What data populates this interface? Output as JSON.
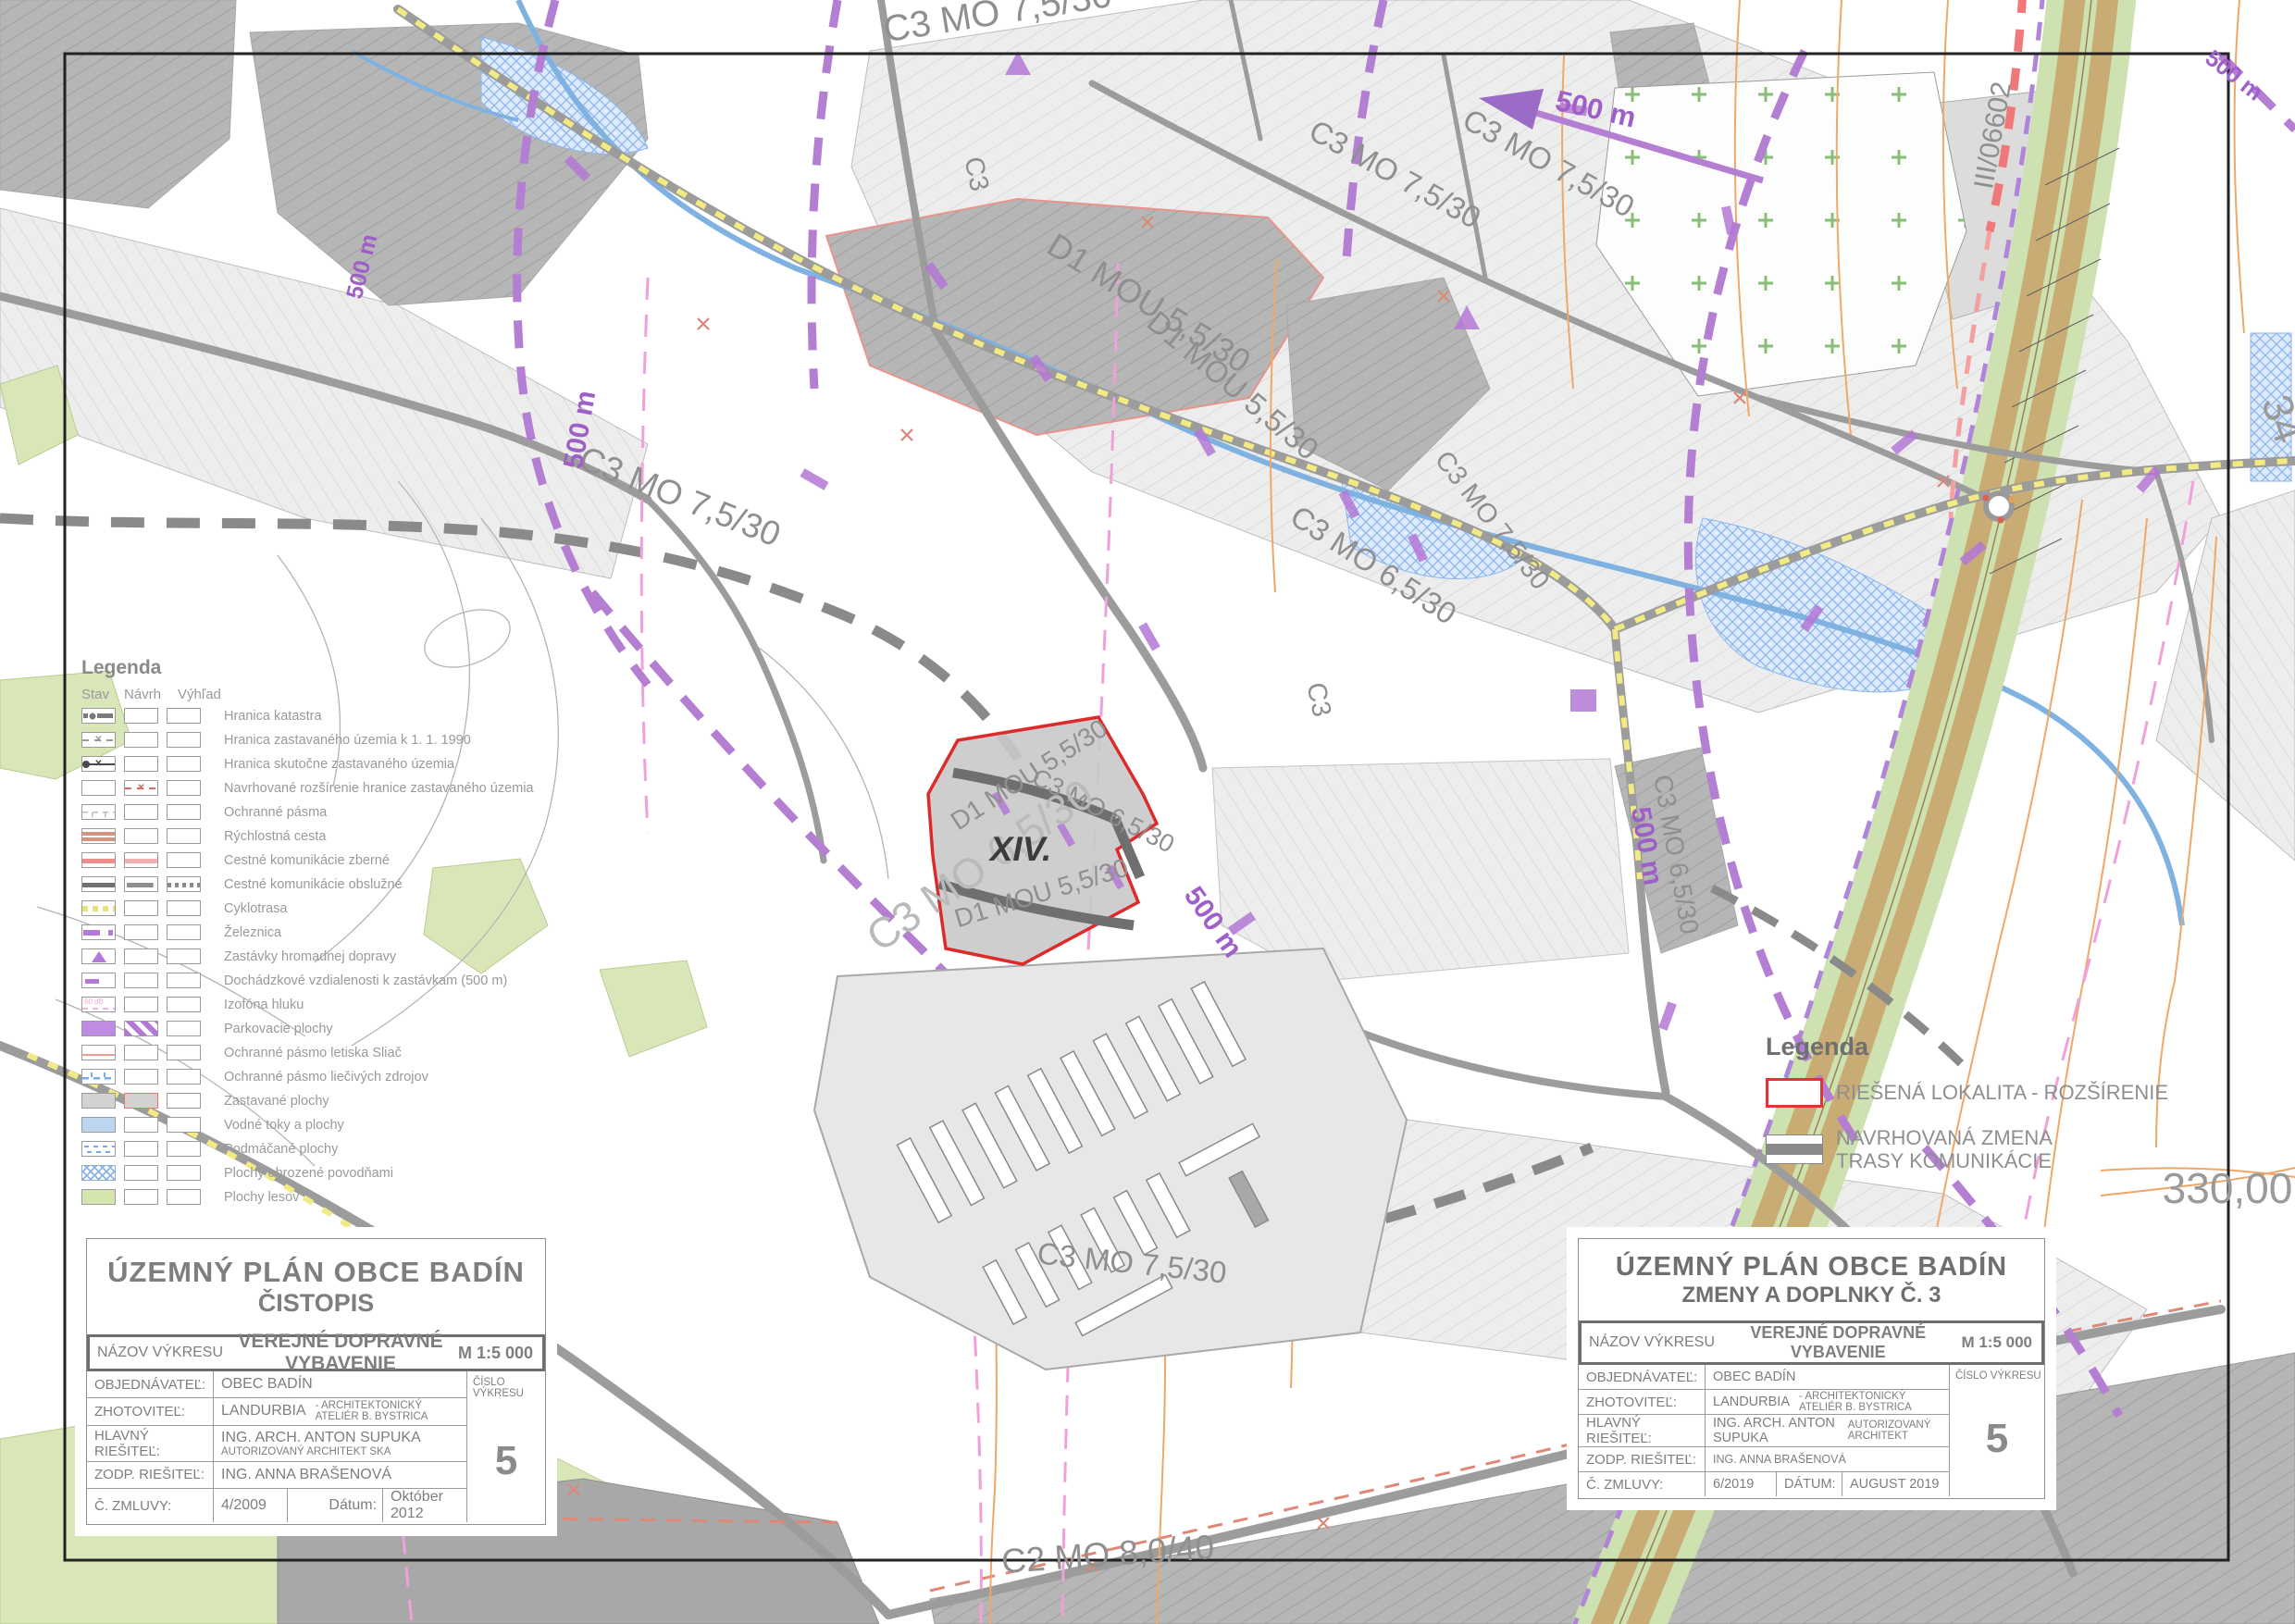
{
  "legend_left": {
    "title": "Legenda",
    "columns": [
      "Stav",
      "Návrh",
      "Výhľad"
    ],
    "izofona_text": "60 dB",
    "items": [
      {
        "label": "Hranica katastra"
      },
      {
        "label": "Hranica zastavaného územia k 1. 1. 1990"
      },
      {
        "label": "Hranica skutočne zastavaného územia"
      },
      {
        "label": "Navrhované rozšírenie hranice zastavaného územia"
      },
      {
        "label": "Ochranné pásma"
      },
      {
        "label": "Rýchlostná cesta"
      },
      {
        "label": "Cestné komunikácie zberné"
      },
      {
        "label": "Cestné komunikácie obslužné"
      },
      {
        "label": "Cyklotrasa"
      },
      {
        "label": "Železnica"
      },
      {
        "label": "Zastávky hromadnej dopravy"
      },
      {
        "label": "Dochádzkové vzdialenosti k zastávkam (500 m)"
      },
      {
        "label": "Izofóna hluku"
      },
      {
        "label": "Parkovacie plochy"
      },
      {
        "label": "Ochranné pásmo letiska Sliač"
      },
      {
        "label": "Ochranné pásmo liečivých zdrojov"
      },
      {
        "label": "Zastavané plochy"
      },
      {
        "label": "Vodné toky a plochy"
      },
      {
        "label": "Podmáčané plochy"
      },
      {
        "label": "Plochy ohrozené povodňami"
      },
      {
        "label": "Plochy lesov"
      }
    ]
  },
  "legend_right": {
    "title": "Legenda",
    "item1": "RIEŠENÁ LOKALITA - ROZŠÍRENIE",
    "item2_line1": "NAVRHOVANÁ ZMENA",
    "item2_line2": "TRASY KOMUNIKÁCIE"
  },
  "title_block_left": {
    "title": "ÚZEMNÝ  PLÁN OBCE BADÍN",
    "subtitle": "ČISTOPIS",
    "nazov_label": "NÁZOV VÝKRESU",
    "nazov_value": "VEREJNÉ DOPRAVNÉ VYBAVENIE",
    "scale": "M 1:5 000",
    "cislo_vykresu_label": "ČÍSLO VÝKRESU",
    "drawing_number": "5",
    "rows": [
      {
        "label": "OBJEDNÁVATEĽ:",
        "value": "OBEC BADÍN",
        "value2": ""
      },
      {
        "label": "ZHOTOVITEĽ:",
        "value": "LANDURBIA",
        "value2": "- ARCHITEKTONICKÝ ATELIÉR B. BYSTRICA"
      },
      {
        "label": "HLAVNÝ RIEŠITEĽ:",
        "value": "ING. ARCH. ANTON SUPUKA",
        "value2": "AUTORIZOVANÝ  ARCHITEKT  SKA"
      },
      {
        "label": "ZODP. RIEŠITEĽ:",
        "value": "ING. ANNA BRAŠENOVÁ",
        "value2": ""
      }
    ],
    "contract_label": "Č. ZMLUVY:",
    "contract_value": "4/2009",
    "date_label": "Dátum:",
    "date_value": "Október 2012"
  },
  "title_block_right": {
    "title": "ÚZEMNÝ PLÁN OBCE BADÍN",
    "subtitle": "ZMENY A DOPLNKY Č. 3",
    "nazov_label": "NÁZOV VÝKRESU",
    "nazov_value": "VEREJNÉ DOPRAVNÉ VYBAVENIE",
    "scale": "M 1:5 000",
    "cislo_vykresu_label": "ČÍSLO VÝKRESU",
    "drawing_number": "5",
    "rows": [
      {
        "label": "OBJEDNÁVATEĽ:",
        "value": "OBEC BADÍN",
        "value2": ""
      },
      {
        "label": "ZHOTOVITEĽ:",
        "value": "LANDURBIA",
        "value2": "- ARCHITEKTONICKÝ ATELIÉR B. BYSTRICA"
      },
      {
        "label": "HLAVNÝ RIEŠITEĽ:",
        "value": "ING. ARCH. ANTON SUPUKA",
        "value2": "AUTORIZOVANÝ ARCHITEKT"
      },
      {
        "label": "ZODP. RIEŠITEĽ:",
        "value": "ING. ANNA BRAŠENOVÁ",
        "value2": ""
      }
    ],
    "contract_label": "Č. ZMLUVY:",
    "contract_value": "6/2019",
    "date_label": "DÁTUM:",
    "date_value": "AUGUST  2019"
  },
  "map": {
    "labels": [
      {
        "text": "C3 MO 7,5/30"
      },
      {
        "text": "D1 MOU 5,5/30"
      },
      {
        "text": "C3 MO 7,5/30"
      },
      {
        "text": "C3 MO 7,5/30"
      },
      {
        "text": "500 m"
      },
      {
        "text": "D1 MOU 5,5/30"
      },
      {
        "text": "C3 MO 6,5/30"
      },
      {
        "text": "C3 MO 7,5/30"
      },
      {
        "text": "C3"
      },
      {
        "text": "C3"
      },
      {
        "text": "C3 MO 7,5/30"
      },
      {
        "text": "500 m"
      },
      {
        "text": "500 m"
      },
      {
        "text": "C3 MO 6,5/30"
      },
      {
        "text": "C3 MO 6,5/30"
      },
      {
        "text": "D1 MOU 5,5/30"
      },
      {
        "text": "D1 MOU 5,5/30"
      },
      {
        "text": "XIV."
      },
      {
        "text": "500 m"
      },
      {
        "text": "C3 MO 6,5/30"
      },
      {
        "text": "500 m"
      },
      {
        "text": "C3 MO 7,5/30"
      },
      {
        "text": "C2 MO 8,0/40"
      },
      {
        "text": "330,00"
      },
      {
        "text": "34"
      },
      {
        "text": "III/06602"
      },
      {
        "text": "500 m"
      }
    ]
  }
}
